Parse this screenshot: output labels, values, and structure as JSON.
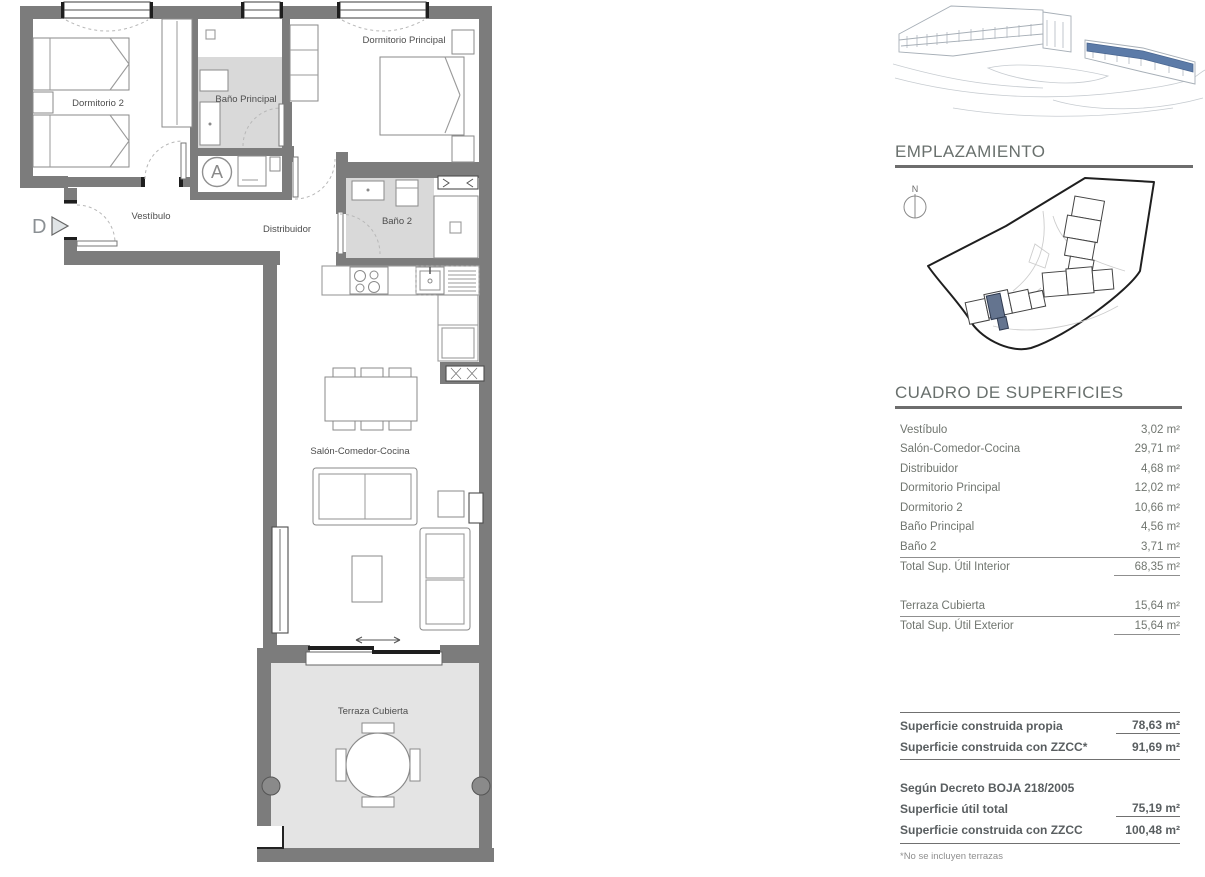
{
  "plan": {
    "rooms": {
      "dormitorio2": "Dormitorio 2",
      "bano_principal": "Baño Principal",
      "dormitorio_principal": "Dormitorio Principal",
      "vestibulo": "Vestíbulo",
      "distribuidor": "Distribuidor",
      "bano2": "Baño 2",
      "salon": "Salón-Comedor-Cocina",
      "terraza": "Terraza Cubierta"
    },
    "markers": {
      "entrance": "D",
      "unit": "A"
    }
  },
  "emplazamiento": {
    "title": "EMPLAZAMIENTO",
    "north": "N"
  },
  "surfaces": {
    "title": "CUADRO DE SUPERFICIES",
    "rows": [
      {
        "label": "Vestíbulo",
        "value": "3,02 m²"
      },
      {
        "label": "Salón-Comedor-Cocina",
        "value": "29,71 m²"
      },
      {
        "label": "Distribuidor",
        "value": "4,68 m²"
      },
      {
        "label": "Dormitorio Principal",
        "value": "12,02 m²"
      },
      {
        "label": "Dormitorio 2",
        "value": "10,66 m²"
      },
      {
        "label": "Baño Principal",
        "value": "4,56 m²"
      },
      {
        "label": "Baño 2",
        "value": "3,71 m²"
      }
    ],
    "total_interior": {
      "label": "Total Sup. Útil Interior",
      "value": "68,35 m²"
    },
    "terraza": {
      "label": "Terraza Cubierta",
      "value": "15,64 m²"
    },
    "total_exterior": {
      "label": "Total Sup. Útil Exterior",
      "value": "15,64 m²"
    }
  },
  "summary": {
    "construida_propia": {
      "label": "Superficie construida propia",
      "value": "78,63 m²"
    },
    "construida_zzcc": {
      "label": "Superficie construida con ZZCC*",
      "value": "91,69 m²"
    },
    "decreto": "Según Decreto BOJA 218/2005",
    "util_total": {
      "label": "Superficie útil total",
      "value": "75,19 m²"
    },
    "construida_zzcc2": {
      "label": "Superficie construida con ZZCC",
      "value": "100,48 m²"
    },
    "footnote": "*No se incluyen terrazas"
  },
  "colors": {
    "highlight_blue": "#5c7ba8",
    "site_unit_blue": "#64748f",
    "wall_gray": "#7c7c7c",
    "bath_floor": "#d9d9d9",
    "terrace_floor": "#e4e4e4",
    "heading_gray": "#69706d"
  }
}
